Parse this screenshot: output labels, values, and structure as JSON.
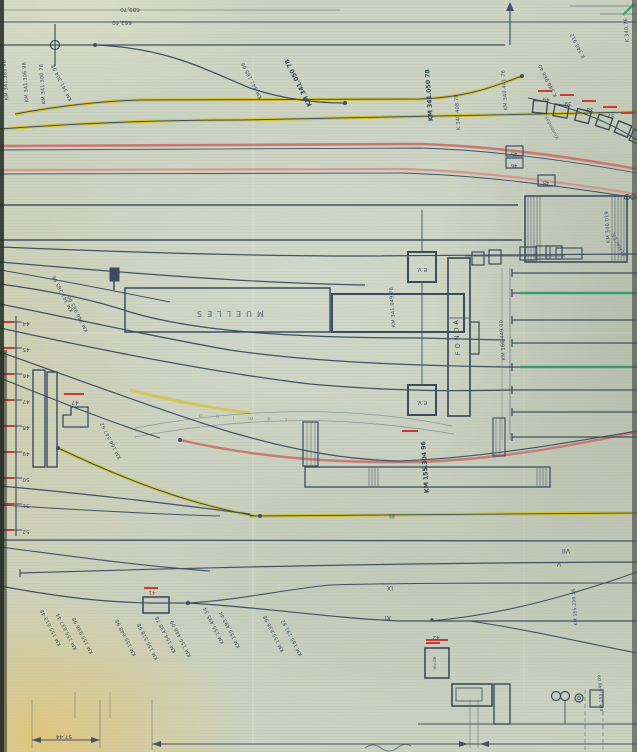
{
  "colors": {
    "paper": "#cbd2c1",
    "ink": "#3f5165",
    "yellow_track": "#d4c22e",
    "red_track": "#c8736d",
    "red_mark": "#c63b33",
    "green_track": "#2fa06c"
  },
  "top_numbers": [
    {
      "text": "689,70"
    },
    {
      "text": "662,40"
    }
  ],
  "km_labels": [
    {
      "text": "KM 341.385 96"
    },
    {
      "text": "KM 341.306 98"
    },
    {
      "text": "KM 341.300 78"
    },
    {
      "text": "KM 341.304 98"
    },
    {
      "text": "KM 341.185 06"
    },
    {
      "text": "KM 341.050 78"
    },
    {
      "text": "KM 341.050 78"
    },
    {
      "text": "K 340.408 78"
    },
    {
      "text": "KM 340.441 76"
    },
    {
      "text": "K 340.966 40"
    },
    {
      "text": "K 340.912"
    },
    {
      "text": "K 340.76"
    },
    {
      "text": "KM 340.019"
    },
    {
      "text": "KM 341.285 96"
    },
    {
      "text": "KM 340.985 06"
    },
    {
      "text": "KM 341.049 78"
    },
    {
      "text": "KM 166.449 00"
    },
    {
      "text": "KM 166.547 62"
    },
    {
      "text": "KM 155.304 96"
    },
    {
      "text": "KM 155.613 48"
    },
    {
      "text": "KM 155.637 44"
    },
    {
      "text": "KM 155.936 98"
    },
    {
      "text": "KM 155.648 98"
    },
    {
      "text": "KM 155.518 68"
    },
    {
      "text": "KM 154.438 78"
    },
    {
      "text": "KM 150.446 09"
    },
    {
      "text": "KM 155.495 34"
    },
    {
      "text": "KM 155.493 44"
    },
    {
      "text": "KM 155.636 98"
    },
    {
      "text": "KM 155.191 82"
    },
    {
      "text": "KM 155.236 16"
    },
    {
      "text": "KM 155.446 09"
    }
  ],
  "buildings": {
    "muelles": "MUELLES",
    "fonda": "FONDA",
    "ev_upper": "E.V.",
    "ev_lower": "E.V.",
    "vivienda_box": "Viv.da"
  },
  "road_label": {
    "text": "c a m i n o"
  },
  "structure_numbers": [
    {
      "text": "40"
    },
    {
      "text": "39"
    },
    {
      "text": "38"
    },
    {
      "text": "37"
    },
    {
      "text": "45"
    },
    {
      "text": "46"
    },
    {
      "text": "48"
    },
    {
      "text": "47"
    },
    {
      "text": "42"
    },
    {
      "text": "41"
    }
  ],
  "edge_numbers": [
    {
      "text": "44"
    },
    {
      "text": "45"
    },
    {
      "text": "46"
    },
    {
      "text": "47"
    },
    {
      "text": "48"
    },
    {
      "text": "49"
    },
    {
      "text": "50"
    },
    {
      "text": "51"
    },
    {
      "text": "52"
    }
  ],
  "track_numerals": [
    {
      "text": "III"
    },
    {
      "text": "V"
    },
    {
      "text": "VII"
    },
    {
      "text": "IX"
    },
    {
      "text": "XI"
    }
  ],
  "dimensions": [
    {
      "text": "57,44"
    }
  ],
  "annotations": [
    {
      "text": "Viviendas"
    },
    {
      "text": "ALMACEN"
    }
  ]
}
